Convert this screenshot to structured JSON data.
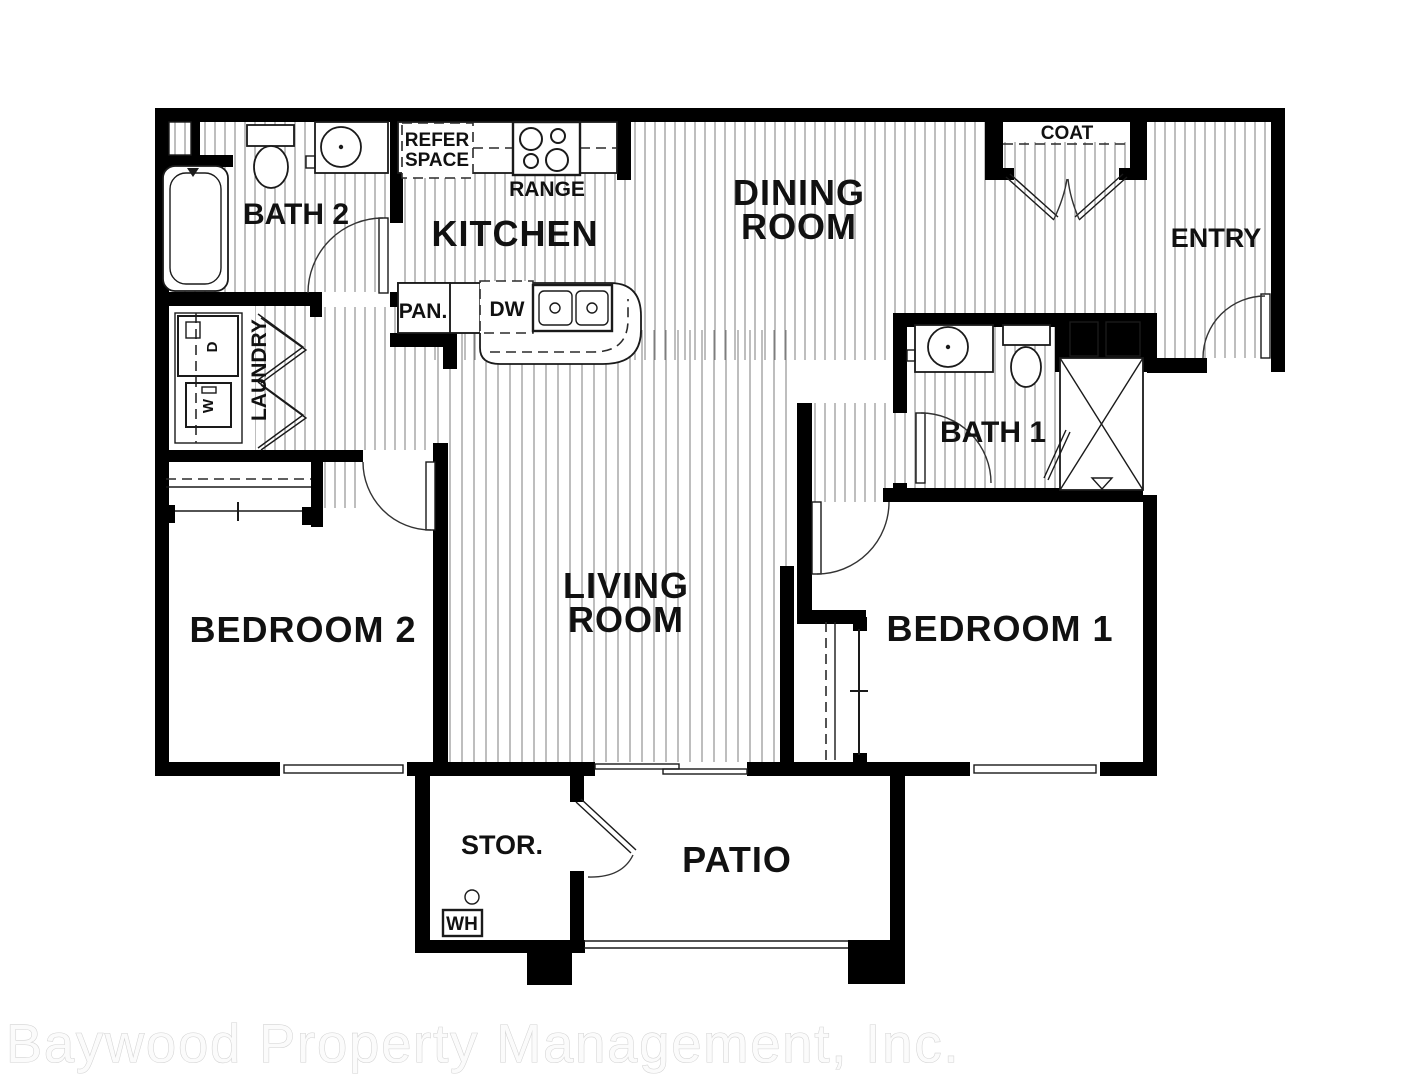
{
  "watermark": "Baywood Property Management, Inc.",
  "labels": {
    "bath2": "BATH 2",
    "kitchen": "KITCHEN",
    "dining1": "DINING",
    "dining2": "ROOM",
    "coat": "COAT",
    "entry": "ENTRY",
    "refer1": "REFER",
    "refer2": "SPACE",
    "range": "RANGE",
    "pan": "PAN.",
    "dw": "DW",
    "laundry": "LAUNDRY",
    "bath1": "BATH 1",
    "bedroom2": "BEDROOM 2",
    "living1": "LIVING",
    "living2": "ROOM",
    "bedroom1": "BEDROOM 1",
    "stor": "STOR.",
    "patio": "PATIO",
    "wh": "WH",
    "dryer": "D",
    "washer": "W"
  },
  "colors": {
    "wall": "#000000",
    "label": "#111111",
    "hatch_line": "#7d7d7d",
    "watermark_fill": "#fbfbfb",
    "watermark_outline": "#d2d2d2",
    "background": "#ffffff"
  }
}
